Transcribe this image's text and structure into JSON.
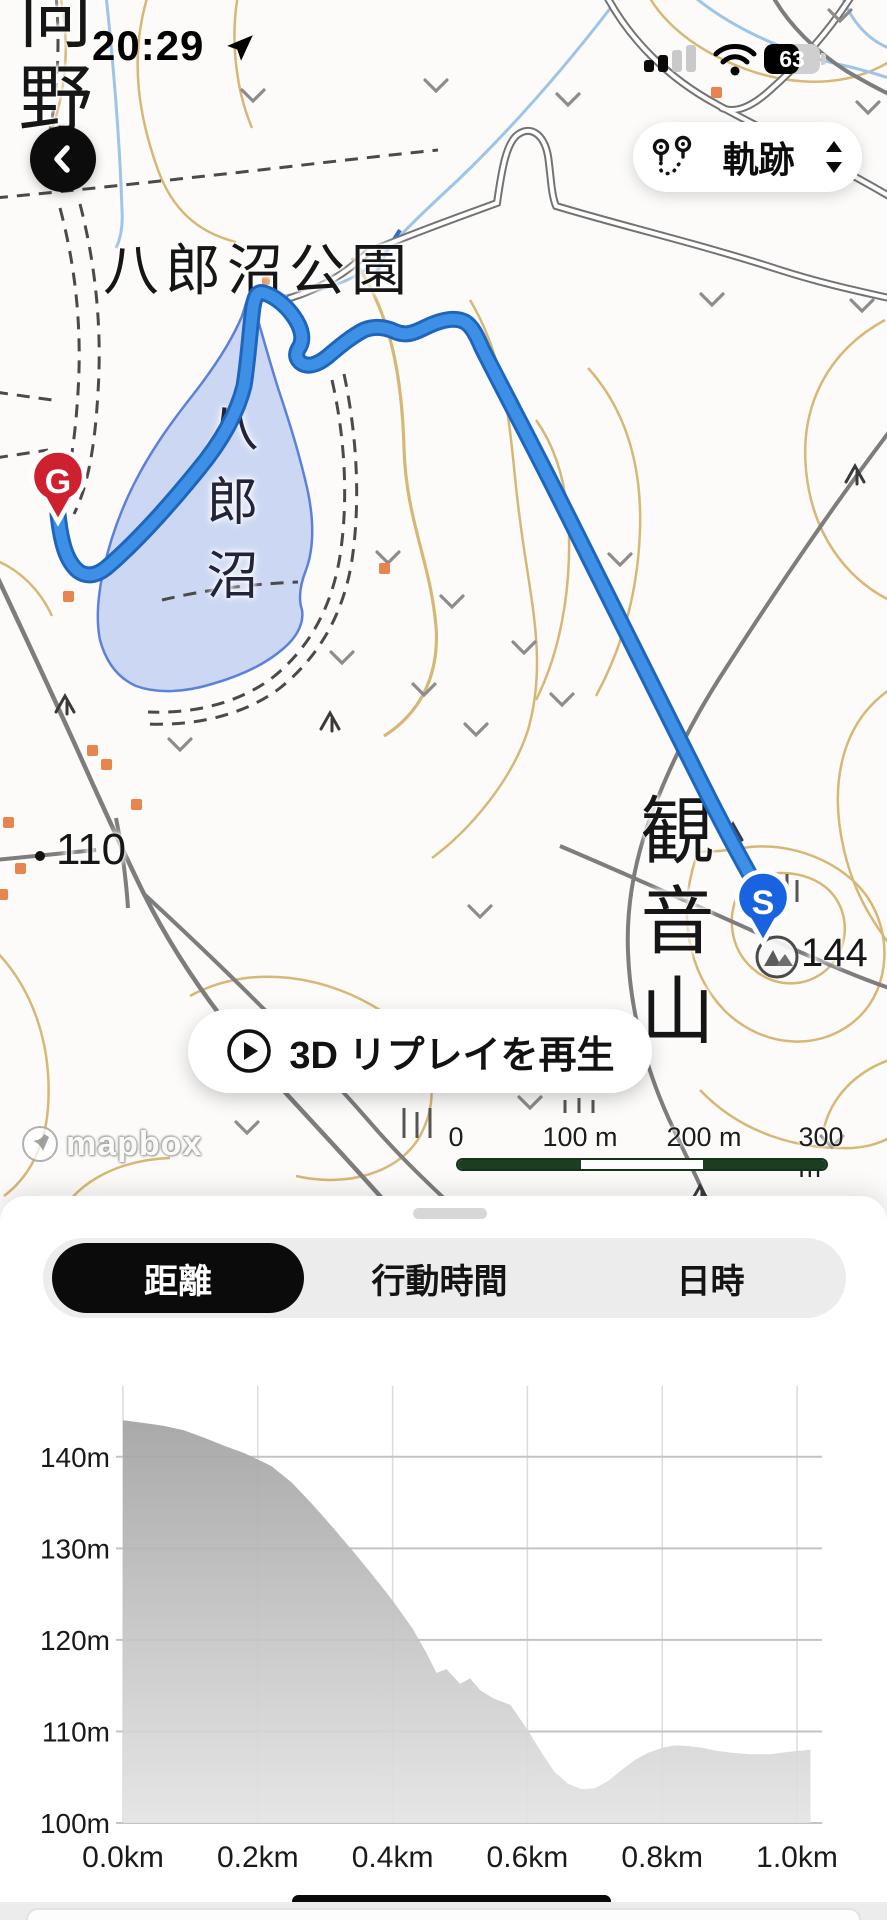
{
  "status_bar": {
    "time": "20:29",
    "battery_percent": "63"
  },
  "map": {
    "track_selector": {
      "label": "軌跡"
    },
    "replay_button": {
      "label": "3D リプレイを再生"
    },
    "labels": {
      "place_top_left": "向野",
      "park": "八郎沼公園",
      "lake": "八郎沼",
      "mountain": "観音山",
      "spot_height_110": "110",
      "peak_height_144": "144"
    },
    "markers": {
      "start": "S",
      "goal": "G"
    },
    "scale_bar": {
      "ticks": [
        "0",
        "100 m",
        "200 m",
        "300 m"
      ]
    },
    "attribution": "mapbox"
  },
  "bottom_sheet": {
    "tabs": [
      {
        "label": "距離",
        "selected": true
      },
      {
        "label": "行動時間",
        "selected": false
      },
      {
        "label": "日時",
        "selected": false
      }
    ]
  },
  "chart_data": {
    "type": "area",
    "title": "",
    "xlabel": "distance (km)",
    "ylabel": "elevation (m)",
    "x_unit": "km",
    "y_unit": "m",
    "grid": true,
    "xlim": [
      0,
      1.04
    ],
    "ylim": [
      100,
      145
    ],
    "x_tick_km": [
      0,
      0.2,
      0.4,
      0.6,
      0.8,
      1.0
    ],
    "xlabel_ticks": [
      "0.0km",
      "0.2km",
      "0.4km",
      "0.6km",
      "0.8km",
      "1.0km"
    ],
    "y_tick_m": [
      100,
      110,
      120,
      130,
      140
    ],
    "ylabel_ticks": [
      "100m",
      "110m",
      "120m",
      "130m",
      "140m"
    ],
    "fill_style": "gray-gradient",
    "profile": [
      [
        0.0,
        144.0
      ],
      [
        0.03,
        143.7
      ],
      [
        0.06,
        143.4
      ],
      [
        0.09,
        142.9
      ],
      [
        0.12,
        142.1
      ],
      [
        0.15,
        141.2
      ],
      [
        0.18,
        140.4
      ],
      [
        0.2,
        139.7
      ],
      [
        0.22,
        139.0
      ],
      [
        0.25,
        137.2
      ],
      [
        0.28,
        134.9
      ],
      [
        0.31,
        132.4
      ],
      [
        0.34,
        129.8
      ],
      [
        0.37,
        127.1
      ],
      [
        0.4,
        124.3
      ],
      [
        0.43,
        121.2
      ],
      [
        0.45,
        118.6
      ],
      [
        0.465,
        116.4
      ],
      [
        0.48,
        116.8
      ],
      [
        0.5,
        115.2
      ],
      [
        0.515,
        115.8
      ],
      [
        0.53,
        114.5
      ],
      [
        0.55,
        113.6
      ],
      [
        0.575,
        112.9
      ],
      [
        0.6,
        110.2
      ],
      [
        0.62,
        107.8
      ],
      [
        0.64,
        105.6
      ],
      [
        0.66,
        104.3
      ],
      [
        0.68,
        103.7
      ],
      [
        0.7,
        103.8
      ],
      [
        0.72,
        104.6
      ],
      [
        0.74,
        105.8
      ],
      [
        0.76,
        106.9
      ],
      [
        0.78,
        107.7
      ],
      [
        0.8,
        108.2
      ],
      [
        0.82,
        108.5
      ],
      [
        0.84,
        108.4
      ],
      [
        0.86,
        108.2
      ],
      [
        0.88,
        107.9
      ],
      [
        0.9,
        107.7
      ],
      [
        0.93,
        107.5
      ],
      [
        0.96,
        107.5
      ],
      [
        0.99,
        107.8
      ],
      [
        1.02,
        108.0
      ]
    ]
  }
}
